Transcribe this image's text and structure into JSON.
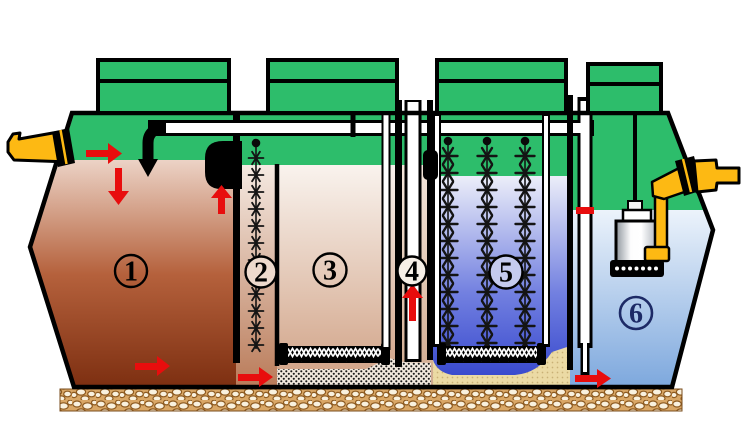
{
  "diagram": {
    "kind": "multi-chamber wastewater treatment tank cross-section",
    "visible_text": [
      "1",
      "2",
      "3",
      "4",
      "5",
      "6"
    ],
    "chambers": [
      {
        "label": "1",
        "fill_top": "#ecd3c6",
        "fill_bottom": "#7c2e10",
        "water_level_y": 160
      },
      {
        "label": "2",
        "fill_top": "#f5eae2",
        "fill_bottom": "#b97a58",
        "water_level_y": 165,
        "media_strings": 1
      },
      {
        "label": "3",
        "fill_top": "#f9f3ee",
        "fill_bottom": "#cf9f82",
        "water_level_y": 165,
        "has_diffuser": true,
        "has_sludge_layer": true
      },
      {
        "label": "4",
        "fill_top": "#f4e7dc",
        "fill_bottom": "#cfa88c",
        "water_level_y": 165,
        "has_airlift_tube": true
      },
      {
        "label": "5",
        "fill_top": "#eceef9",
        "fill_bottom": "#3041cb",
        "water_level_y": 176,
        "media_strings": 3,
        "has_diffuser": true,
        "has_sand_layer": true
      },
      {
        "label": "6",
        "fill_top": "#ecf3fb",
        "fill_bottom": "#7ca7dd",
        "water_level_y": 210,
        "has_pump": true
      }
    ],
    "colors": {
      "shell_green": "#2dbd6b",
      "outline_black": "#000000",
      "pipe_white": "#ffffff",
      "pipe_yellow": "#fdb913",
      "arrow_red": "#e80d0d",
      "gravel_tan": "#d9a766",
      "sand_tan": "#ebdaa4",
      "sludge_dots": "#1a1a1a",
      "number6_navy": "#1d2a66"
    },
    "features": [
      "inlet-pipe-left",
      "outlet-pipe-right",
      "air-manifold-pipe",
      "inlet-drop-elbow",
      "four-access-lids",
      "submersible-pump",
      "diffuser-bars",
      "biofilm-media-strings",
      "transfer-pipe-with-red-level-mark",
      "gravel-foundation"
    ],
    "flow_arrows": [
      {
        "id": "inlet-right",
        "direction": "right"
      },
      {
        "id": "chamber1-down",
        "direction": "down"
      },
      {
        "id": "chamber1-up-to-elbow",
        "direction": "up"
      },
      {
        "id": "chamber1-bottom-to-2",
        "direction": "right"
      },
      {
        "id": "chamber2-bottom-to-3",
        "direction": "right"
      },
      {
        "id": "chamber4-airlift-up",
        "direction": "up"
      },
      {
        "id": "chamber5-bottom-to-6",
        "direction": "right"
      }
    ]
  }
}
